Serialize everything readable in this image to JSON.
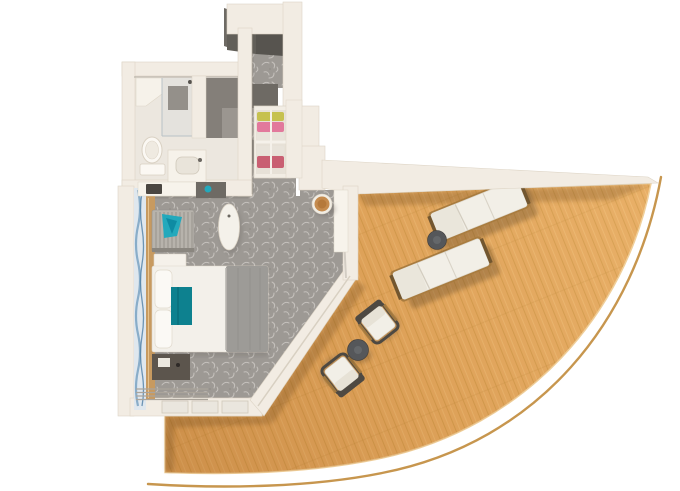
{
  "scene": {
    "description": "Top-down 3D rendered floor plan of a cruise ship stateroom with a curved wrap-around balcony",
    "style": "photorealistic render on white background"
  },
  "palette": {
    "background": "#ffffff",
    "wall": "#f2ece3",
    "wall-edge": "#ddd4c5",
    "wall-dark": "#6e6a64",
    "wall-darker": "#57544f",
    "carpet": "#9d9994",
    "carpet-motif": "#c9c5c0",
    "bath-floor": "#ece7df",
    "wood": "#e6aa60",
    "wood-line": "#c9913f",
    "wood-light": "#f2c27c",
    "railing": "#c49044",
    "fabric-white": "#f2efe7",
    "fabric-gray": "#9d9b97",
    "teal": "#0d818f",
    "teal-light": "#23a9bc",
    "curtain-blue": "#7fa6c4",
    "curtain-blue-dark": "#4f7fa6",
    "ledge-wood": "#c79a60",
    "dark-furniture": "#5c554d",
    "stool-leather": "#c58b4e",
    "table-dark": "#55575a",
    "chair-frame": "#4e4942",
    "lounger-frame": "#a97c3f",
    "clothes-yellow": "#c6c14f",
    "clothes-pink": "#e2799c",
    "clothes-red": "#c95f72"
  },
  "rooms": [
    {
      "name": "bathroom",
      "furniture": [
        "shower",
        "toilet",
        "sink-vanity"
      ]
    },
    {
      "name": "entry-hall",
      "furniture": [
        "entry-door",
        "wardrobe-shelves"
      ]
    },
    {
      "name": "bedroom",
      "furniture": [
        "armchair",
        "teal-throw",
        "white-nightstand",
        "bed",
        "pillows",
        "gray-duvet",
        "teal-bed-runner",
        "dark-nightstand",
        "oval-ottoman",
        "vanity-counter",
        "vanity-stool",
        "media-console",
        "window-curtain",
        "sliding-door"
      ]
    },
    {
      "name": "balcony",
      "furniture": [
        "sun-lounger-1",
        "sun-lounger-2",
        "lounger-side-table",
        "dining-chair-1",
        "dining-chair-2",
        "dining-table",
        "deck-railing"
      ]
    }
  ]
}
